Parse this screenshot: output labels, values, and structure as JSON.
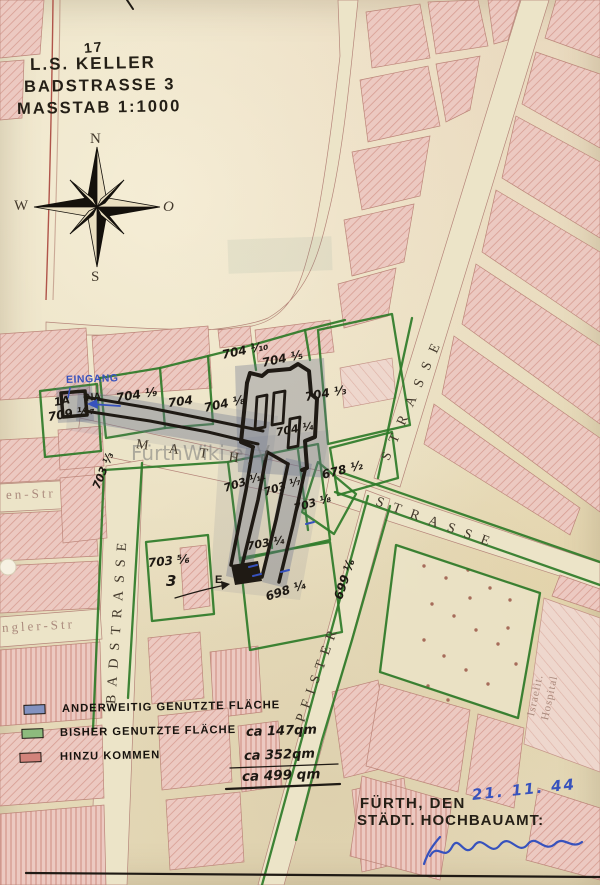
{
  "colors": {
    "green_ink": "#2e7b28",
    "blue_ink": "#3752bd",
    "black_ink": "#1f1a14",
    "shade": "#6a728c"
  },
  "meta": {
    "sheet_note": "17"
  },
  "title": {
    "line1": "L.S. KELLER",
    "line2": "BADSTRASSE 3",
    "line3": "MASSTAB 1:1000"
  },
  "compass": {
    "north": "N",
    "south": "S",
    "west": "W",
    "east": "O"
  },
  "watermark": "FürthWiki e. V.",
  "annotations": {
    "entrance": "EINGANG",
    "na": "NA",
    "house_1a": "1A",
    "exit": "E"
  },
  "streets": {
    "math": "M A T H.",
    "badstrasse": "BADSTRASSE",
    "pfister": "PFISTER",
    "strasse_ne": "STRASSE",
    "strasse_se": "STRASSE",
    "en_str": "en-Str",
    "ngler_str": "ngler-Str",
    "hospital1": "Israelit.",
    "hospital2": "Hospital"
  },
  "parcels": [
    {
      "text": "709 ¹⁄₁₇"
    },
    {
      "text": "704 ¹⁄₉"
    },
    {
      "text": "704"
    },
    {
      "text": "704 ¹⁄₈"
    },
    {
      "text": "704 ¹⁄₁₀"
    },
    {
      "text": "704 ¹⁄₅"
    },
    {
      "text": "704 ¹⁄₃"
    },
    {
      "text": "704 ¹⁄₄"
    },
    {
      "text": "678 ¹⁄₂"
    },
    {
      "text": "703 ¹⁄₁₁"
    },
    {
      "text": "703 ¹⁄₇"
    },
    {
      "text": "703 ¹⁄₈"
    },
    {
      "text": "703 ¹⁄₄"
    },
    {
      "text": "698 ¹⁄₄"
    },
    {
      "text": "703 ⁵⁄₆"
    },
    {
      "text": "3"
    },
    {
      "text": "699 ¹⁄₆"
    },
    {
      "text": "703 ¹⁄₃"
    }
  ],
  "legend": {
    "items": [
      {
        "swatch": "#8292c0",
        "label": "ANDERWEITIG GENUTZTE FLÄCHE",
        "value": ""
      },
      {
        "swatch": "#8dbb7d",
        "label": "BISHER GENUTZTE FLÄCHE",
        "value": "ca 147qm"
      },
      {
        "swatch": "#d2837b",
        "label": "HINZU KOMMEN",
        "value": "ca 352qm"
      }
    ],
    "total": "ca 499 qm"
  },
  "footer": {
    "city": "FÜRTH, DEN",
    "date": "21. 11. 44",
    "office": "STÄDT. HOCHBAUAMT:"
  }
}
